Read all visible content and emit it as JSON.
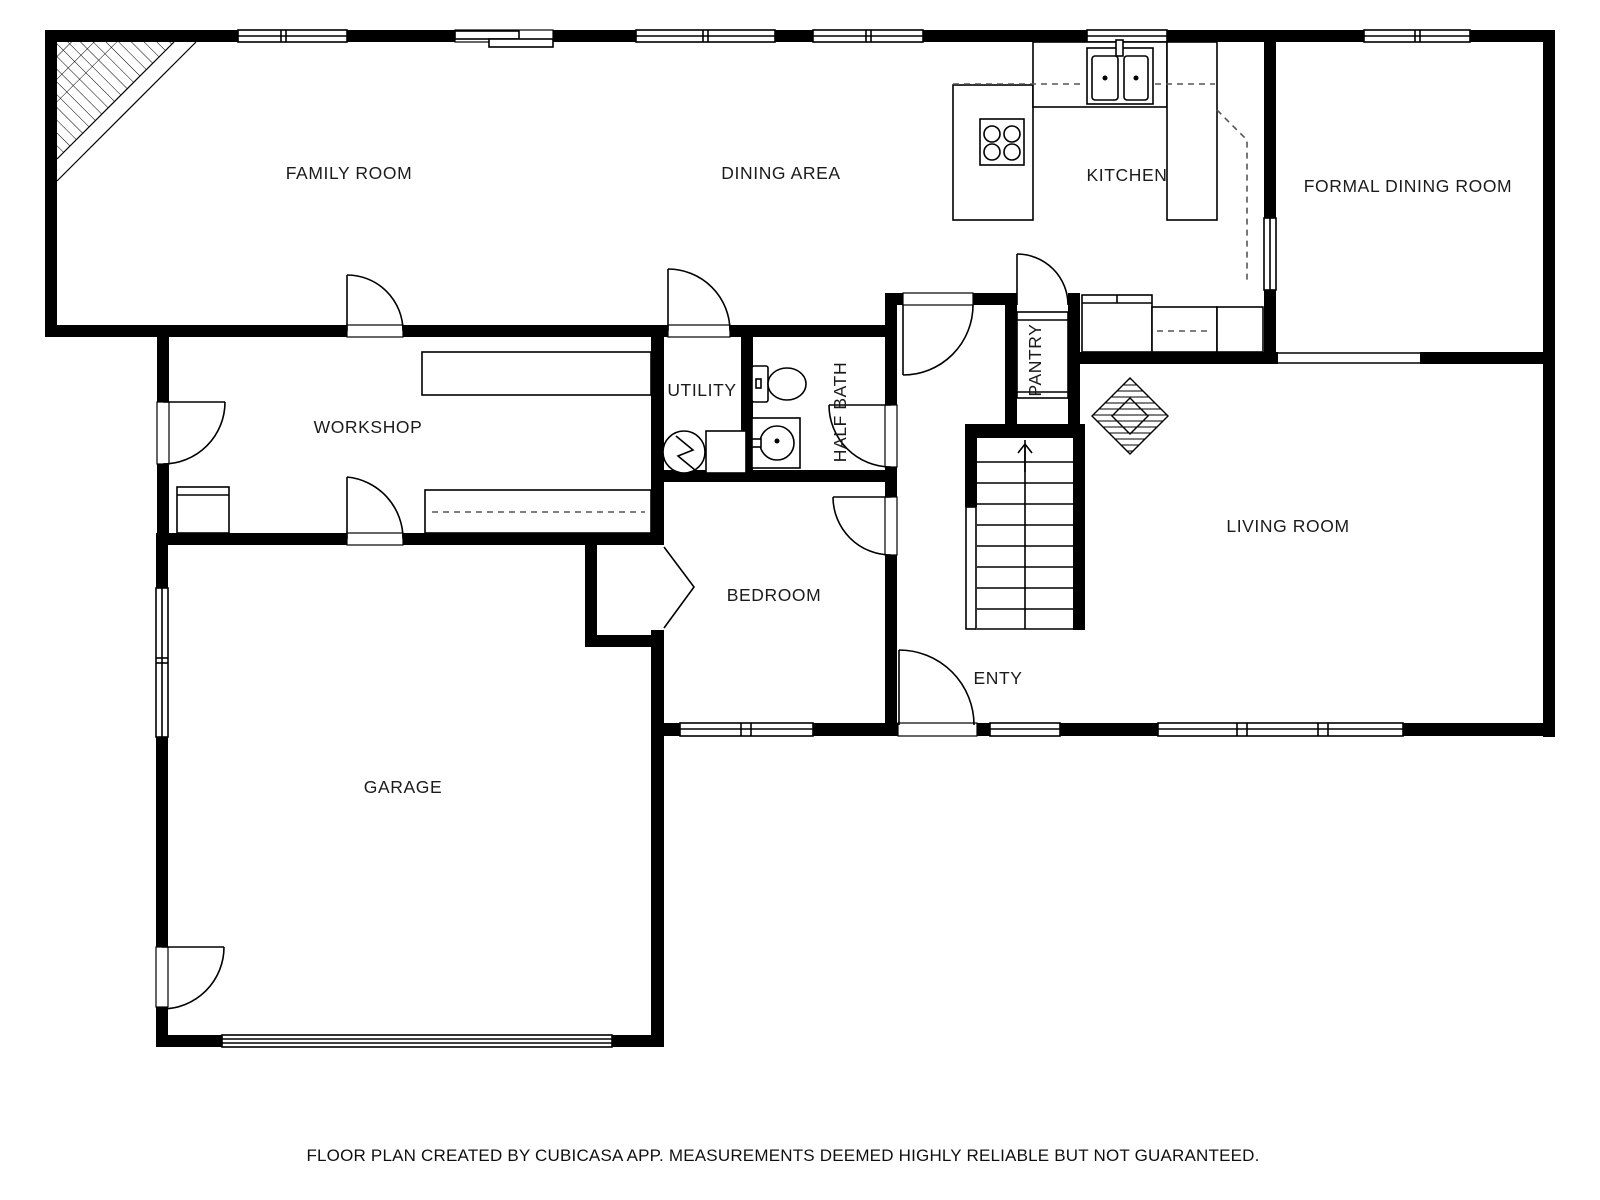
{
  "page": {
    "type": "floor-plan",
    "background": "#ffffff",
    "wall_color": "#000000",
    "line_color": "#000000",
    "text_color": "#1b1b1b"
  },
  "rooms": {
    "family_room": {
      "label": "FAMILY ROOM"
    },
    "dining_area": {
      "label": "DINING AREA"
    },
    "kitchen": {
      "label": "KITCHEN"
    },
    "formal_dining_room": {
      "label": "FORMAL DINING ROOM"
    },
    "workshop": {
      "label": "WORKSHOP"
    },
    "utility": {
      "label": "UTILITY"
    },
    "half_bath": {
      "label": "HALF BATH"
    },
    "pantry": {
      "label": "PANTRY"
    },
    "living_room": {
      "label": "LIVING ROOM"
    },
    "bedroom": {
      "label": "BEDROOM"
    },
    "entry": {
      "label": "ENTY"
    },
    "garage": {
      "label": "GARAGE"
    }
  },
  "fixtures": [
    "corner-fireplace-hatch",
    "stove-4-burner",
    "kitchen-double-sink",
    "refrigerator",
    "kitchen-counters",
    "upper-cabinets-dashed",
    "pantry-shelf",
    "staircase-up-arrow",
    "diamond-fireplace",
    "toilet",
    "bathroom-sink",
    "water-heater",
    "freezer-box",
    "workbench",
    "closet-bifold-door",
    "garage-overhead-door",
    "door-swings",
    "windows",
    "sliding-patio-door"
  ],
  "footer": {
    "text": "FLOOR PLAN CREATED BY CUBICASA APP. MEASUREMENTS DEEMED HIGHLY RELIABLE BUT NOT GUARANTEED."
  }
}
